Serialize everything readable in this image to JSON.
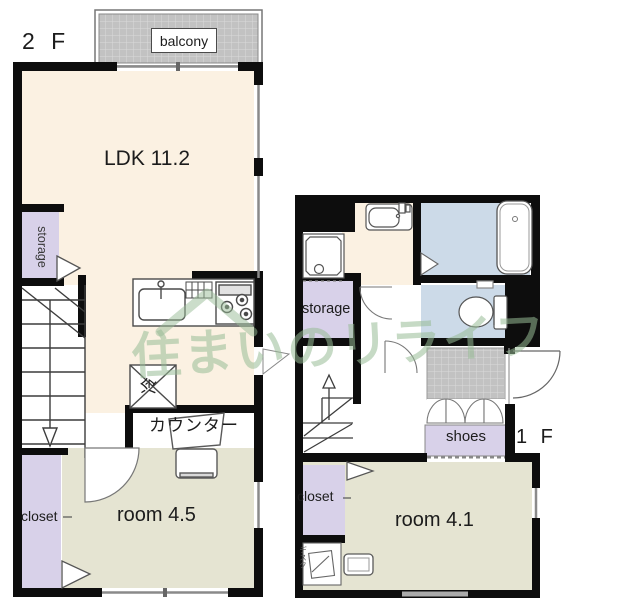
{
  "labels": {
    "floor2": "2 F",
    "floor1": "1 F",
    "balcony": "balcony",
    "ldk": "LDK 11.2",
    "storage_2f": "storage",
    "fridge": "冷",
    "counter": "カウンター",
    "closet_2f": "closet",
    "room_2f": "room 4.5",
    "storage_1f": "storage",
    "shoes": "shoes",
    "closet_1f": "closet",
    "room_1f": "room 4.1",
    "desk_1f": "デスク",
    "watermark": "住まいのリライフ"
  },
  "rooms": {
    "ldk_size": "11.2",
    "room_2f_size": "4.5",
    "room_1f_size": "4.1"
  },
  "colors": {
    "wall": "#0d0d0d",
    "ldk_floor": "#fbf1e2",
    "room_floor": "#e5e4d2",
    "closet_fill": "#d8d1e9",
    "wet_area_fill": "#ccdae8",
    "hatch_base": "#c2c2c2",
    "watermark_green": "#97bb96",
    "fixture_line": "#555555"
  }
}
